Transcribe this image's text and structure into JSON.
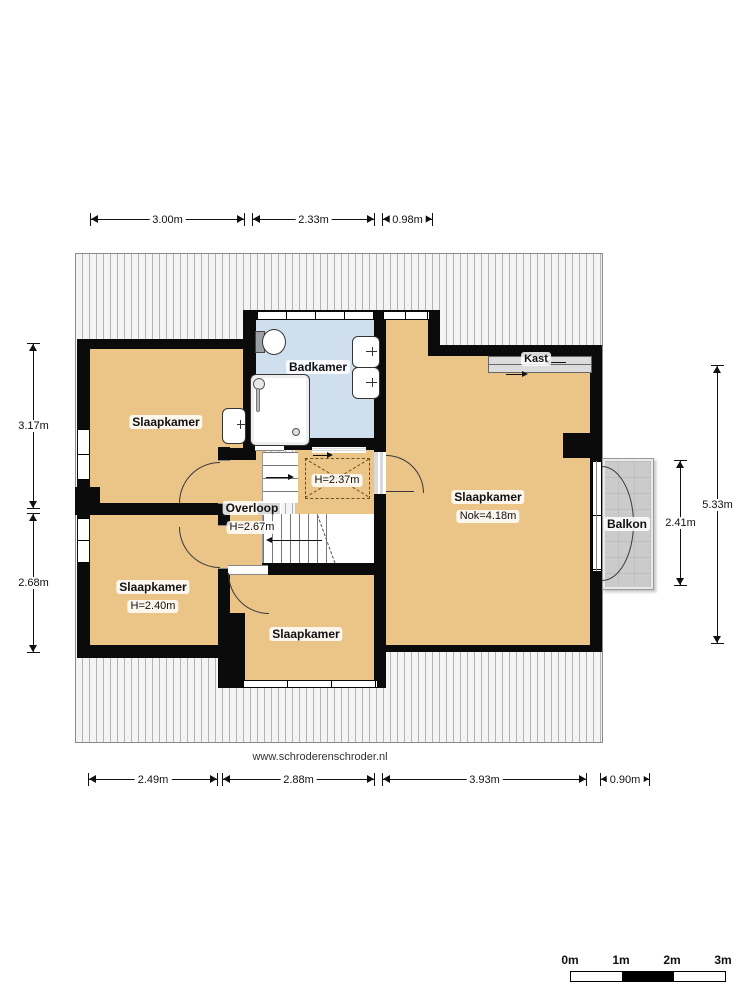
{
  "site": {
    "url": "www.schroderenschroder.nl"
  },
  "rooms": {
    "bedroom_top_left": {
      "name": "Slaapkamer"
    },
    "bathroom": {
      "name": "Badkamer"
    },
    "bedroom_bottom_left": {
      "name": "Slaapkamer",
      "height": "H=2.40m"
    },
    "bedroom_bottom_middle": {
      "name": "Slaapkamer"
    },
    "bedroom_main": {
      "name": "Slaapkamer",
      "ridge": "Nok=4.18m"
    },
    "landing": {
      "name": "Overloop",
      "height": "H=2.67m"
    },
    "low_ceiling_area": {
      "height": "H=2.37m"
    },
    "closet": {
      "name": "Kast"
    },
    "balcony": {
      "name": "Balkon"
    }
  },
  "dimensions": {
    "top": [
      "3.00m",
      "2.33m",
      "0.98m"
    ],
    "bottom": [
      "2.49m",
      "2.88m",
      "3.93m",
      "0.90m"
    ],
    "left": [
      "3.17m",
      "2.68m"
    ],
    "right": [
      "5.33m",
      "2.41m"
    ]
  },
  "scale_bar": {
    "labels": [
      "0m",
      "1m",
      "2m",
      "3m"
    ]
  },
  "colors": {
    "floor": "#ebc488",
    "bathroom_floor": "#cfdfee",
    "wall": "#0b0b0b",
    "balcony": "#cbcbcb",
    "roof_stripe": "#b3b3b3"
  }
}
